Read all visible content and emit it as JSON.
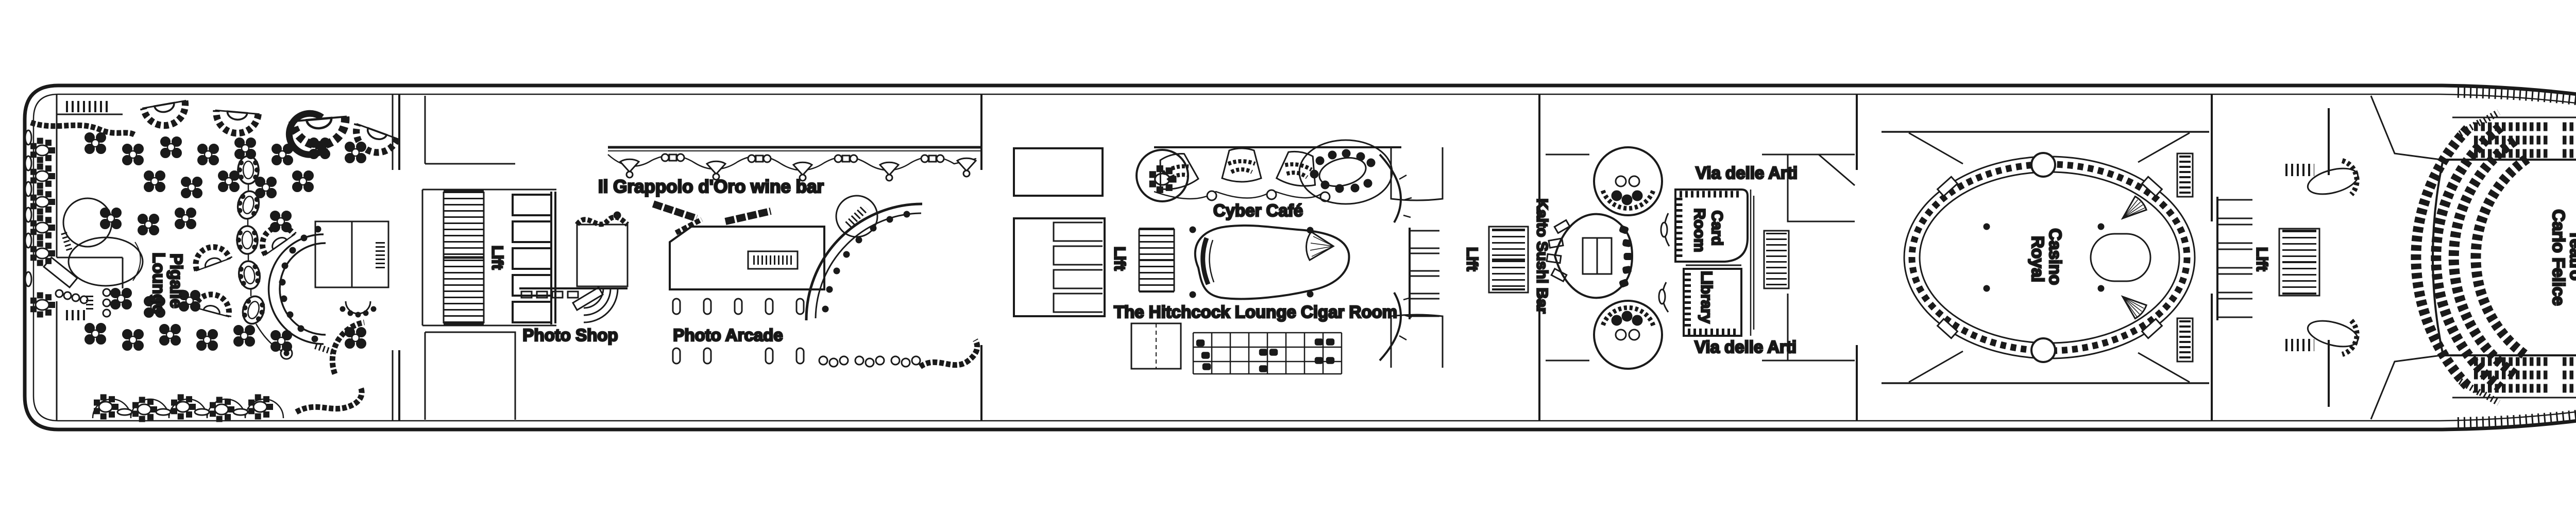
{
  "diagram": {
    "type": "cruise-ship-deck-plan",
    "style": "black and white architectural line drawing",
    "background_color": "#ffffff",
    "line_color": "#1a1a1a",
    "orientation": {
      "stern": "left",
      "bow": "right"
    }
  },
  "venues": {
    "pigalle_lounge": {
      "lines": [
        "Pigalle",
        "Lounge"
      ]
    },
    "lift": "Lift",
    "wine_bar": "Il Grappolo d'Oro wine bar",
    "photo_shop": "Photo Shop",
    "photo_arcade": "Photo Arcade",
    "cyber_cafe": "Cyber Café",
    "hitchcock_cigar": "The Hitchcock Lounge Cigar Room",
    "kaito_sushi": "Kaito Sushi Bar",
    "via_delle_arti": "Via delle Arti",
    "card_room": {
      "lines": [
        "Card",
        "Room"
      ]
    },
    "library": "Library",
    "casino_royal": {
      "lines": [
        "Casino",
        "Royal"
      ]
    },
    "teatro": {
      "lines": [
        "Teatro",
        "Carlo Felice"
      ]
    }
  },
  "label_occurrences": {
    "lift": 4,
    "via_delle_arti": 2
  }
}
